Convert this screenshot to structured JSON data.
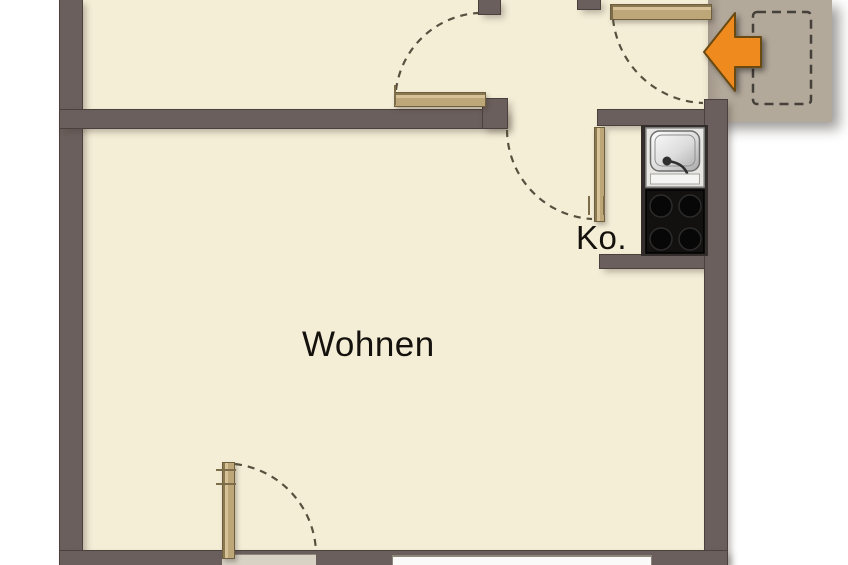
{
  "plan": {
    "rooms": [
      {
        "id": "living",
        "label": "Wohnen"
      },
      {
        "id": "kitchenette",
        "label": "Ko."
      }
    ],
    "entrance_arrow_icon": "arrow-left",
    "colors": {
      "wall": "#6b5f5d",
      "floor": "#f4eed7",
      "landing": "#b3a99b",
      "door": "#c6ae7f",
      "arrow": "#ef8a1e",
      "arrow_outline": "#6b4a12",
      "cooktop": "#131110",
      "sink": "#e7e6e2",
      "swing_dash": "#57503f"
    }
  }
}
